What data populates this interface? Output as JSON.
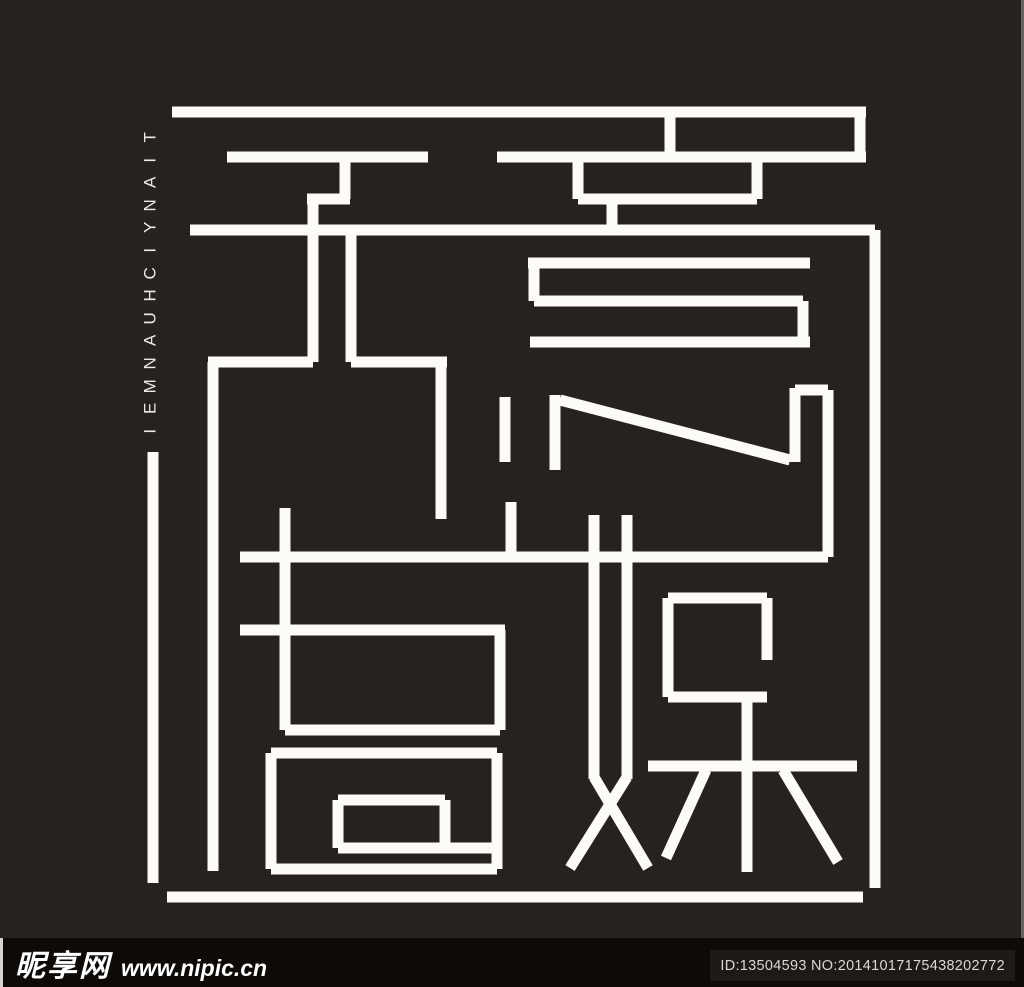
{
  "canvas": {
    "width": 1024,
    "height": 987
  },
  "colors": {
    "background": "#272220",
    "logo_stroke": "#fcfbf8",
    "watermark_bar_bg": "#0d0a07",
    "id_box_bg": "#1e1a16",
    "id_text": "#d9d9d7",
    "brand_text": "#eceae6",
    "edge_line": "#9b9892"
  },
  "brand": {
    "vertical_text": "TIANYICHUANMEI"
  },
  "watermark": {
    "site_name": "昵享网",
    "site_url": "www.nipic.cn",
    "id_label": "ID:13504593 NO:20141017175438202772"
  },
  "logo": {
    "stroke_width": 11,
    "segments": [
      [
        172,
        112,
        866,
        112
      ],
      [
        860,
        112,
        860,
        162
      ],
      [
        497,
        157,
        866,
        157
      ],
      [
        670,
        112,
        670,
        157
      ],
      [
        227,
        157,
        428,
        157
      ],
      [
        345,
        157,
        345,
        199
      ],
      [
        307,
        199,
        350,
        199
      ],
      [
        313,
        199,
        313,
        362
      ],
      [
        190,
        230,
        875,
        230
      ],
      [
        875,
        230,
        875,
        888
      ],
      [
        351,
        230,
        351,
        362
      ],
      [
        208,
        362,
        313,
        362
      ],
      [
        213,
        362,
        213,
        871
      ],
      [
        351,
        362,
        447,
        362
      ],
      [
        441,
        362,
        441,
        519
      ],
      [
        578,
        157,
        578,
        199
      ],
      [
        578,
        199,
        618,
        199
      ],
      [
        612,
        199,
        612,
        235
      ],
      [
        612,
        199,
        757,
        199
      ],
      [
        757,
        157,
        757,
        199
      ],
      [
        528,
        263,
        810,
        263
      ],
      [
        534,
        263,
        534,
        301
      ],
      [
        534,
        301,
        803,
        301
      ],
      [
        803,
        301,
        803,
        342
      ],
      [
        530,
        342,
        810,
        342
      ],
      [
        505,
        397,
        505,
        462
      ],
      [
        511,
        502,
        511,
        557
      ],
      [
        555,
        395,
        555,
        470
      ],
      [
        560,
        400,
        790,
        460
      ],
      [
        795,
        388,
        795,
        462
      ],
      [
        795,
        390,
        828,
        390
      ],
      [
        828,
        390,
        828,
        557
      ],
      [
        240,
        557,
        828,
        557
      ],
      [
        240,
        630,
        505,
        630
      ],
      [
        285,
        508,
        285,
        730
      ],
      [
        285,
        730,
        500,
        730
      ],
      [
        500,
        630,
        500,
        730
      ],
      [
        271,
        753,
        497,
        753
      ],
      [
        271,
        753,
        271,
        869
      ],
      [
        271,
        869,
        497,
        869
      ],
      [
        497,
        753,
        497,
        869
      ],
      [
        338,
        800,
        445,
        800
      ],
      [
        338,
        800,
        338,
        848
      ],
      [
        338,
        848,
        492,
        848
      ],
      [
        445,
        800,
        445,
        848
      ],
      [
        153,
        452,
        153,
        883
      ],
      [
        167,
        897,
        863,
        897
      ],
      [
        594,
        515,
        594,
        779
      ],
      [
        627,
        515,
        627,
        779
      ],
      [
        594,
        777,
        648,
        868
      ],
      [
        627,
        777,
        570,
        868
      ],
      [
        668,
        598,
        767,
        598
      ],
      [
        668,
        598,
        668,
        697
      ],
      [
        668,
        697,
        767,
        697
      ],
      [
        767,
        598,
        767,
        660
      ],
      [
        648,
        766,
        857,
        766
      ],
      [
        747,
        697,
        747,
        872
      ],
      [
        706,
        770,
        666,
        858
      ],
      [
        783,
        770,
        838,
        862
      ]
    ]
  }
}
